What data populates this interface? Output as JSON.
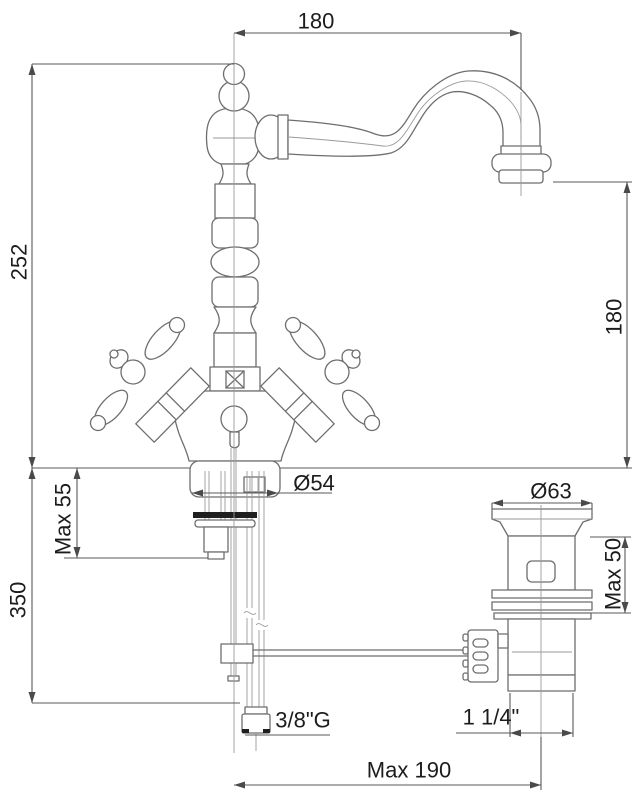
{
  "drawing": {
    "type": "technical dimension drawing",
    "subject": "two-handle classic basin mixer faucet with swivel spout and pop-up waste drain",
    "background": "#ffffff",
    "line_color": "#6e6e6e",
    "text_color": "#1c1c1c"
  },
  "dims": {
    "top_width": "180",
    "left_height": "252",
    "spout_height": "180",
    "base_clamp": "Max 55",
    "hose_length": "350",
    "base_diameter": "Ø54",
    "drain_diameter": "Ø63",
    "drain_clamp": "Max 50",
    "supply_thread": "3/8\"G",
    "drain_thread": "1 1/4\"",
    "rod_reach": "Max 190"
  }
}
